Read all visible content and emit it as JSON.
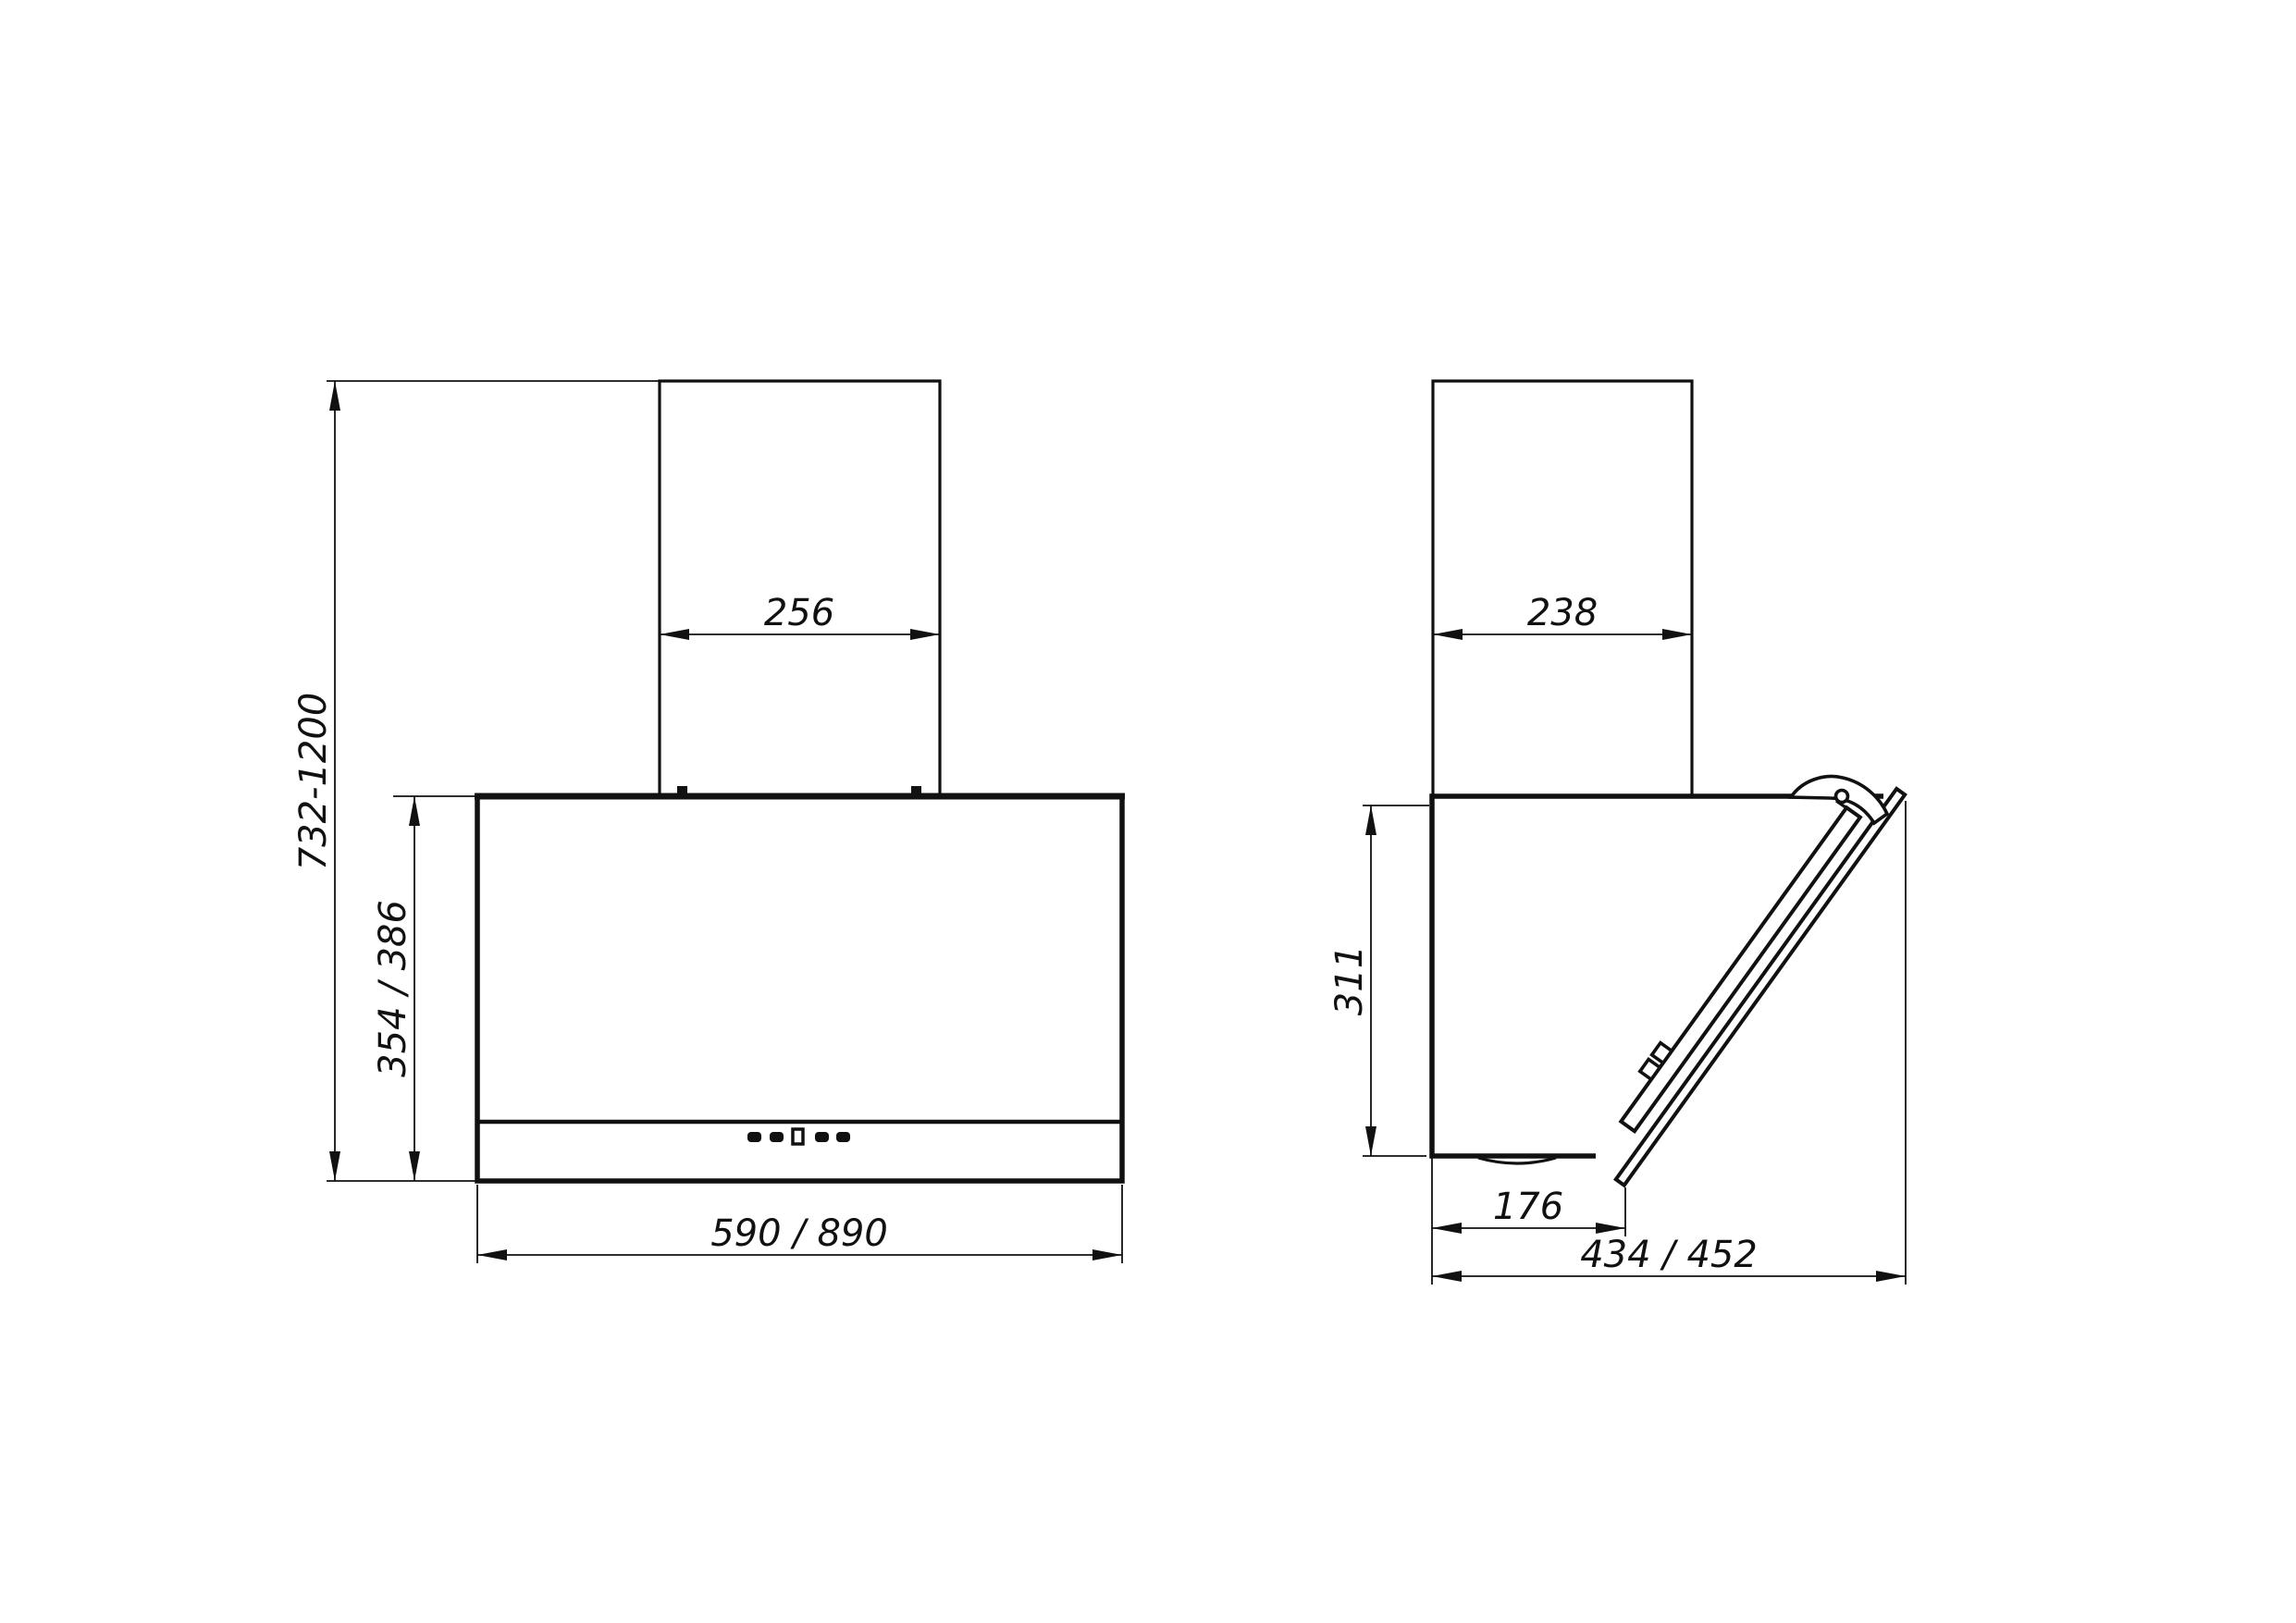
{
  "drawing": {
    "front_view": {
      "chimney_width": "256",
      "mount_height_range": "732-1200",
      "body_height": "354 / 386",
      "body_width": "590 / 890"
    },
    "side_view": {
      "chimney_depth": "238",
      "rear_height": "311",
      "lower_body_depth": "176",
      "total_depth": "434 / 452"
    }
  }
}
